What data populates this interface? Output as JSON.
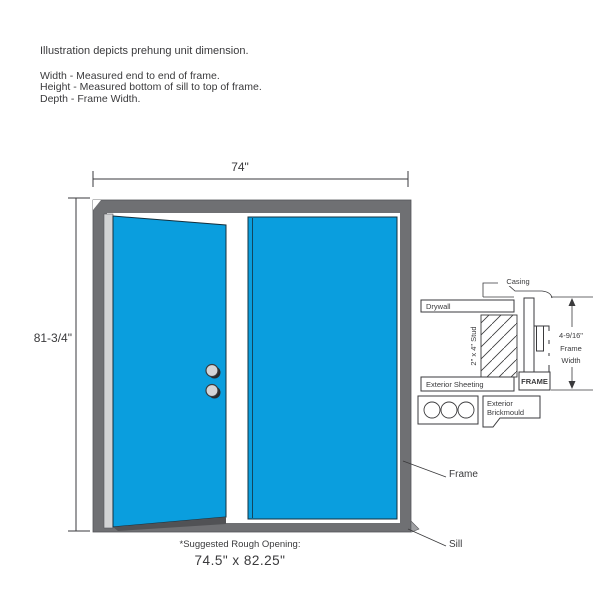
{
  "intro": {
    "line1": "Illustration depicts prehung unit dimension.",
    "line2": "Width - Measured end to end of frame.",
    "line3": "Height - Measured bottom of sill to top of frame.",
    "line4": "Depth - Frame Width."
  },
  "door_unit": {
    "width_dimension": "74\"",
    "height_dimension": "81-3/4\"",
    "frame_callout": "Frame",
    "sill_callout": "Sill",
    "rough_opening_label": "*Suggested Rough Opening:",
    "rough_opening_value": "74.5\" x 82.25\""
  },
  "cross_section": {
    "casing_label": "Casing",
    "drywall_label": "Drywall",
    "stud_label": "2\" x 4\" Stud",
    "sheeting_label": "Exterior Sheeting",
    "frame_label": "FRAME",
    "brickmould_label_line1": "Exterior",
    "brickmould_label_line2": "Brickmould",
    "frame_width_dimension": "4-9/16\"",
    "frame_width_label_line1": "Frame",
    "frame_width_label_line2": "Width"
  },
  "colors": {
    "door_blue": "#0A9EDE",
    "frame_gray": "#6F7073",
    "hinge_gray": "#D2D3D4",
    "outline_dark": "#3A3A3C"
  }
}
